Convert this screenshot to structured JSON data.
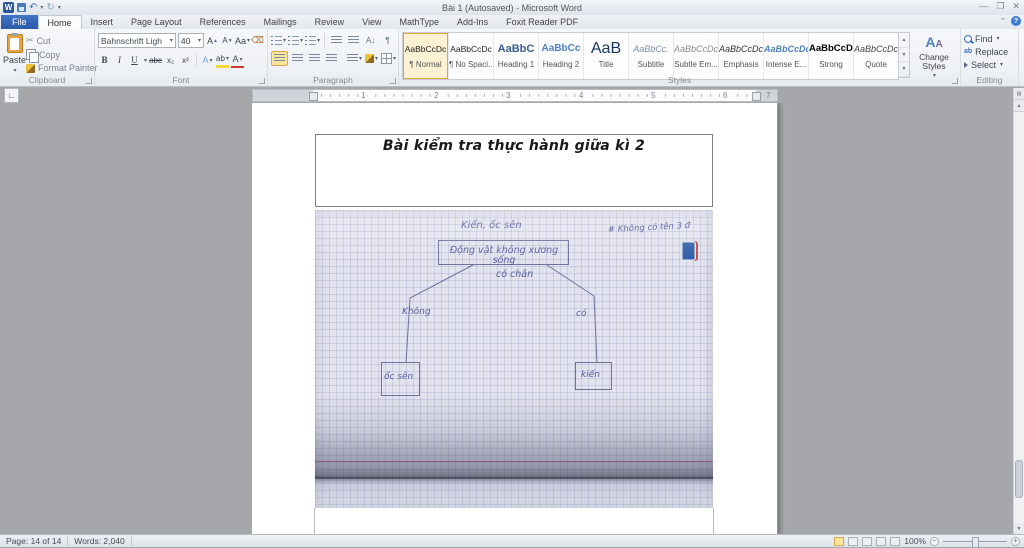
{
  "window": {
    "title": "Bài 1 (Autosaved)  -  Microsoft Word"
  },
  "tabs": [
    "File",
    "Home",
    "Insert",
    "Page Layout",
    "References",
    "Mailings",
    "Review",
    "View",
    "MathType",
    "Add-Ins",
    "Foxit Reader PDF"
  ],
  "ribbon": {
    "clipboard": {
      "group_label": "Clipboard",
      "paste": "Paste",
      "cut": "Cut",
      "copy": "Copy",
      "format_painter": "Format Painter"
    },
    "font": {
      "group_label": "Font",
      "family": "Bahnschrift Ligh",
      "size": "40",
      "bold": "B",
      "italic": "I",
      "underline": "U",
      "strikethrough": "abc",
      "subscript": "x₂",
      "superscript": "x²",
      "grow": "A",
      "shrink": "A",
      "change_case": "Aa",
      "effects": "A",
      "highlight": "ab",
      "color": "A"
    },
    "paragraph": {
      "group_label": "Paragraph",
      "sort": "A↓",
      "pilcrow": "¶"
    },
    "styles": {
      "group_label": "Styles",
      "change_styles": "Change Styles",
      "items": [
        {
          "preview": "AaBbCcDc",
          "name": "¶ Normal"
        },
        {
          "preview": "AaBbCcDc",
          "name": "¶ No Spaci..."
        },
        {
          "preview": "AaBbC",
          "name": "Heading 1"
        },
        {
          "preview": "AaBbCc",
          "name": "Heading 2"
        },
        {
          "preview": "AaB",
          "name": "Title"
        },
        {
          "preview": "AaBbCc.",
          "name": "Subtitle"
        },
        {
          "preview": "AaBbCcDc",
          "name": "Subtle Em..."
        },
        {
          "preview": "AaBbCcDc",
          "name": "Emphasis"
        },
        {
          "preview": "AaBbCcDc",
          "name": "Intense E..."
        },
        {
          "preview": "AaBbCcDc",
          "name": "Strong"
        },
        {
          "preview": "AaBbCcDc",
          "name": "Quote"
        }
      ]
    },
    "editing": {
      "group_label": "Editing",
      "find": "Find",
      "replace": "Replace",
      "select": "Select"
    }
  },
  "ruler": {
    "numbers": [
      "1",
      "2",
      "3",
      "4",
      "5",
      "6",
      "7"
    ]
  },
  "document": {
    "heading": "Bài kiểm tra thực hành giữa kì 2",
    "diagram": {
      "top_label": "Kiến, ốc sên",
      "grade_note": "# Không có tên 3 đ",
      "root_box": "Động vật không xương sống",
      "criterion": "có chân",
      "branch_no": "Không",
      "branch_yes": "có",
      "leaf_no": "ốc sên",
      "leaf_yes": "kiến"
    }
  },
  "status": {
    "page": "Page: 14 of 14",
    "words": "Words: 2,040",
    "zoom_level": "100%"
  },
  "colors": {
    "accent_blue": "#2a5bab",
    "heading_blue": "#4f81bd",
    "selection_amber": "#e0a63c",
    "pencil_ink": "#575c9e"
  }
}
